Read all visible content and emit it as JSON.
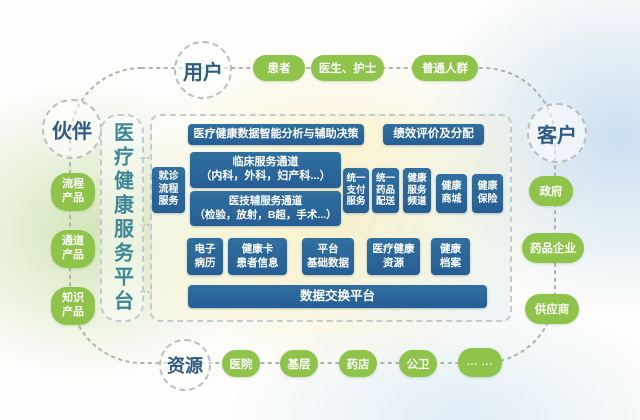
{
  "colors": {
    "green": "#8dc449",
    "blue": "#2c68a0",
    "node_label": "#2d5b85",
    "platform_title": "#3d8796"
  },
  "loop": {
    "users_label": "用户",
    "partners_label": "伙伴",
    "customers_label": "客户",
    "resources_label": "资源",
    "user_items": [
      "患者",
      "医生、护士",
      "普通人群"
    ],
    "partner_items": [
      "流程\n产品",
      "通道\n产品",
      "知识\n产品"
    ],
    "customer_items": [
      "政府",
      "药品企业",
      "供应商"
    ],
    "resource_items": [
      "医院",
      "基层",
      "药店",
      "公卫",
      "... ..."
    ]
  },
  "platform": {
    "title": "医疗健康服务平台",
    "analytics": "医疗健康数据智能分析与辅助决策",
    "performance": "绩效评价及分配",
    "visit_flow": "就诊\n流程\n服务",
    "clinical": "临床服务通道\n（内科，外科，妇产科...）",
    "medtech": "医技辅服务通道\n（检验，放射，B超，手术...）",
    "unified_pay": "统一\n支付\n服务",
    "unified_drug": "统一\n药品\n配送",
    "health_channel": "健康\n服务\n频道",
    "health_mall": "健康\n商城",
    "health_insurance": "健康\n保险",
    "emr": "电子\n病历",
    "health_card": "健康卡\n患者信息",
    "base_data": "平台\n基础数据",
    "med_resources": "医疗健康\n资源",
    "health_archive": "健康\n档案",
    "data_exchange": "数据交换平台"
  }
}
